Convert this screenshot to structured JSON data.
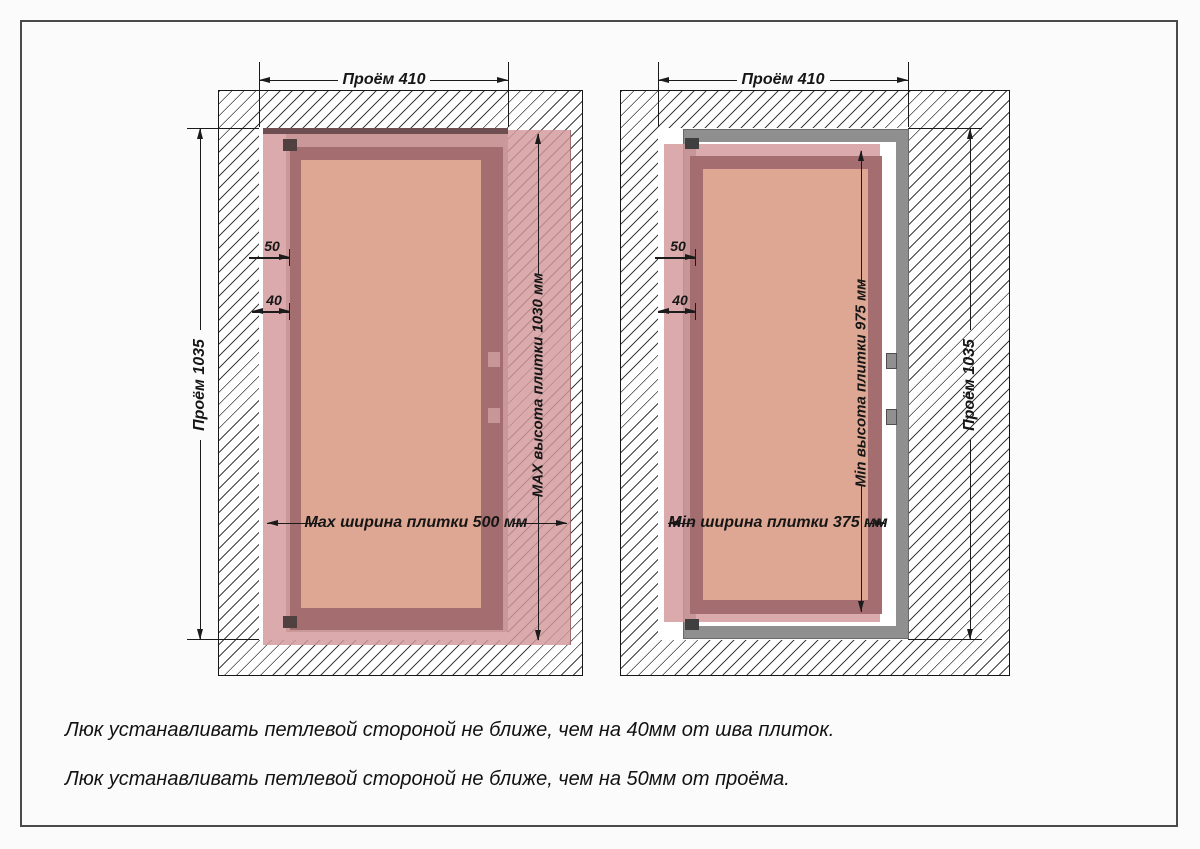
{
  "diagram_left": {
    "opening_width_label": "Проём 410",
    "opening_height_label": "Проём 1035",
    "tile_height_label": "MAX высота плитки 1030 мм",
    "tile_width_label": "Max ширина плитки 500 мм",
    "hinge_offset_opening": "50",
    "hinge_offset_seam": "40"
  },
  "diagram_right": {
    "opening_width_label": "Проём 410",
    "opening_height_label": "Проём 1035",
    "tile_height_label": "Min высота плитки 975 мм",
    "tile_width_label": "Min ширина плитки 375 мм",
    "hinge_offset_opening": "50",
    "hinge_offset_seam": "40"
  },
  "notes": [
    "Люк устанавливать петлевой стороной не ближе,  чем на 40мм от шва плиток.",
    "Люк устанавливать петлевой стороной не ближе,  чем на 50мм от проёма."
  ],
  "colors": {
    "tile_pink": "#d39799",
    "frame_dark": "#a46d70",
    "panel_salmon": "#dda794",
    "metal_frame": "#8f8f8f",
    "hatch_line": "#3d3d3d",
    "page_border": "#4a4a4a"
  }
}
